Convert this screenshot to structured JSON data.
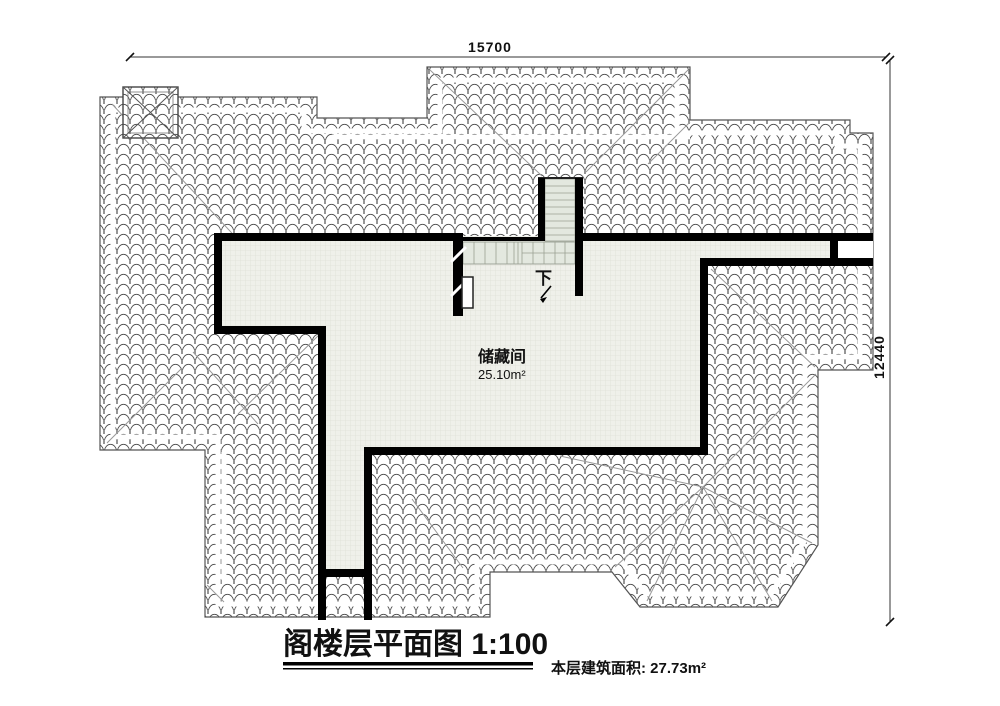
{
  "drawing": {
    "type": "architectural-floor-plan",
    "title_block": {
      "title": "阁楼层平面图 1:100",
      "area_note": "本层建筑面积: 27.73m²"
    },
    "room": {
      "name": "储藏间",
      "area": "25.10m²"
    },
    "stair": {
      "down_label": "下"
    },
    "dimensions": {
      "top_width": "15700",
      "right_height": "12440"
    },
    "colors": {
      "wall": "#000000",
      "stair_fill": "#e3e8df",
      "floor_bg": "#eff0ea",
      "roof_tile_stroke": "#4b4b4b",
      "hip_line": "#9a9a9a"
    }
  }
}
